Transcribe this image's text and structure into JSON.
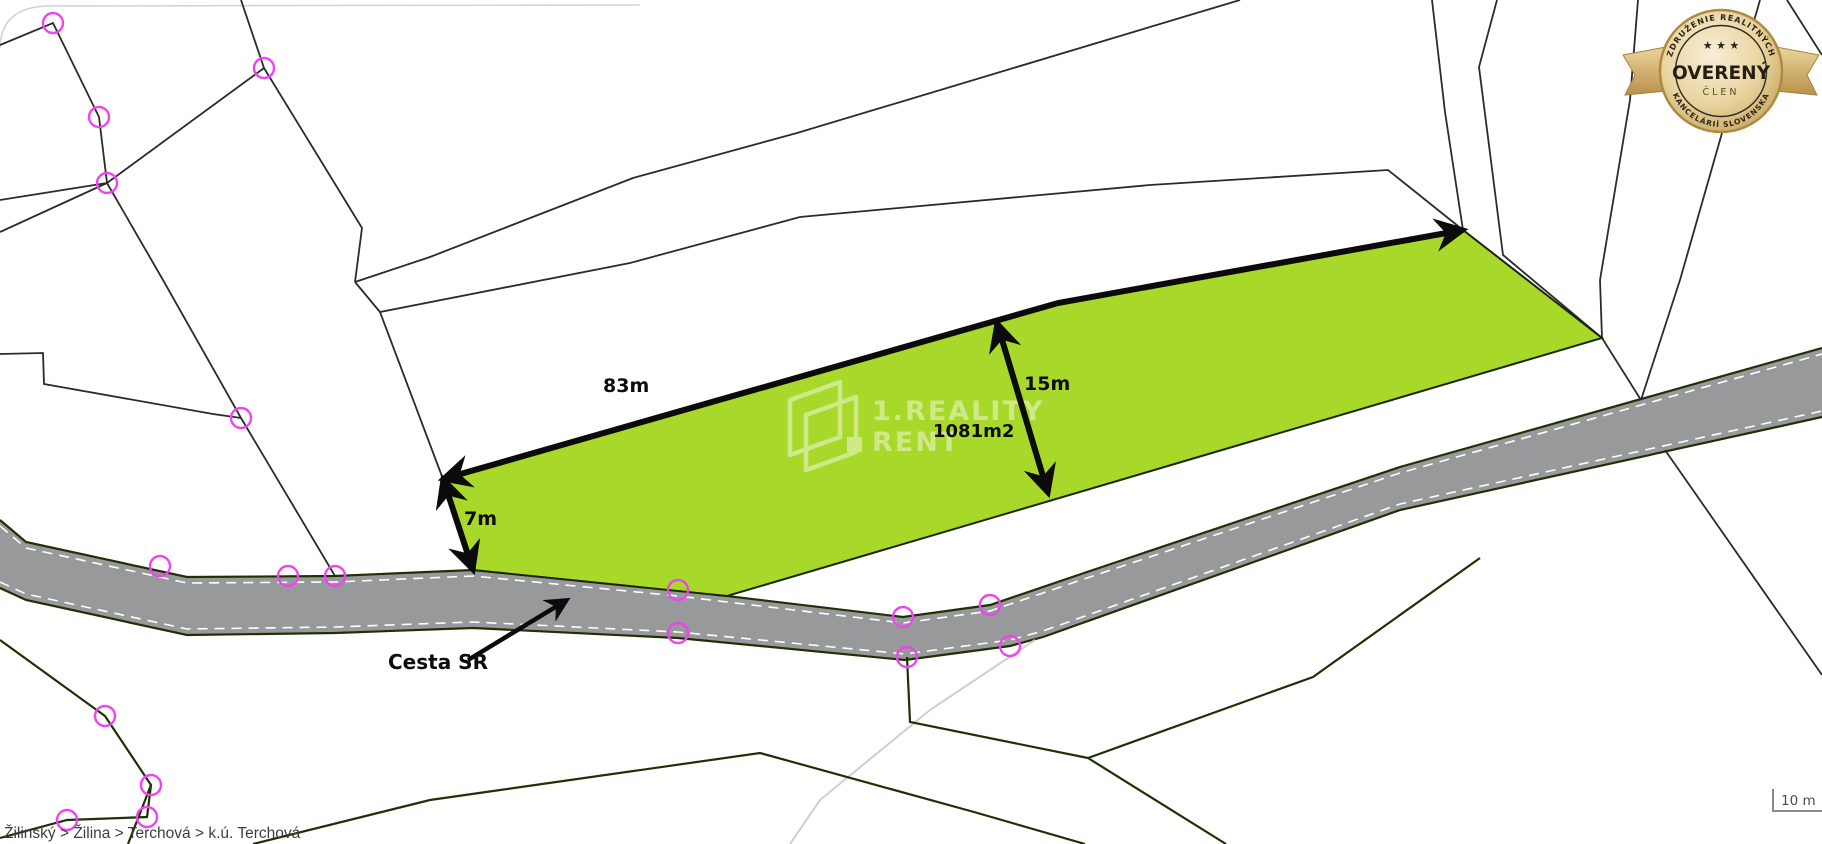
{
  "map": {
    "breadcrumb": "Žilinský > Žilina > Terchová > k.ú. Terchová",
    "scale_label": "10 m",
    "road_label": "Cesta SR",
    "measurements": {
      "top_edge": "83m",
      "width": "15m",
      "left_edge": "7m",
      "area": "1081m2"
    }
  },
  "watermark": {
    "line1": "1.REALITY",
    "line2": "RENT"
  },
  "badge": {
    "arc_top": "ZDRUŽENIE REALITNÝCH",
    "stars": "★ ★ ★",
    "title": "OVERENÝ",
    "subtitle": "ČLEN",
    "arc_bottom": "KANCELÁRIÍ SLOVENSKA"
  },
  "colors": {
    "parcel_fill": "#a8d829",
    "parcel_edge": "#1c2605",
    "road_fill": "#98999a",
    "road_edge": "#263300",
    "vertex_marker": "#ee44ee",
    "badge_gold": "#c9a24b",
    "arrow": "#0b0b0b"
  }
}
